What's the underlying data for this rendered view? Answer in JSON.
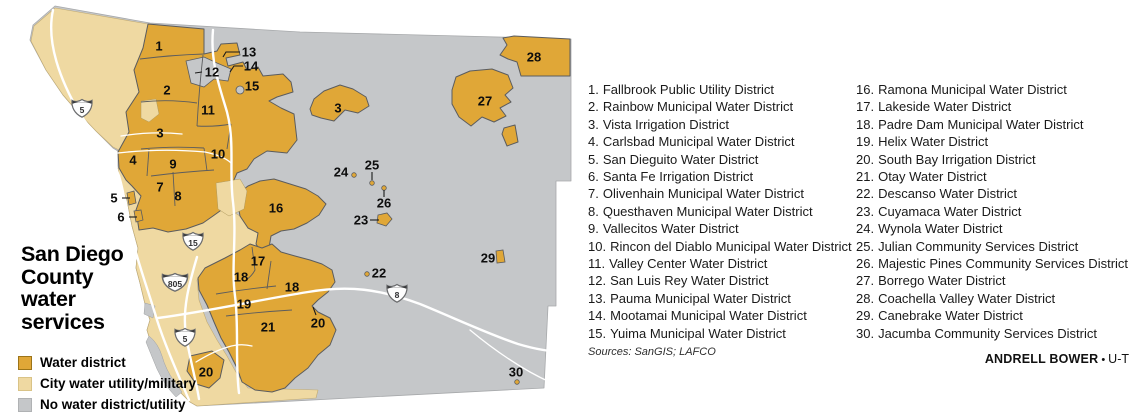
{
  "colors": {
    "gold": "#e0a737",
    "tan": "#efd9a2",
    "gray": "#c5c7c9",
    "border": "#5b5c5e",
    "road": "#ffffff"
  },
  "map_title": {
    "line1": "San Diego",
    "line2": "County",
    "line3": "water",
    "line4": "services"
  },
  "legend": {
    "items": [
      {
        "label": "Water district",
        "color": "#e0a737",
        "border": "#9c7418"
      },
      {
        "label": "City water utility/military",
        "color": "#efd9a2",
        "border": "#d9c387"
      },
      {
        "label": "No water district/utility",
        "color": "#c5c7c9",
        "border": "#b0b2b4"
      }
    ]
  },
  "districts": {
    "column1": [
      {
        "num": "1.",
        "name": "Fallbrook Public Utility District"
      },
      {
        "num": "2.",
        "name": "Rainbow Municipal Water District"
      },
      {
        "num": "3.",
        "name": "Vista Irrigation District"
      },
      {
        "num": "4.",
        "name": "Carlsbad Municipal Water District"
      },
      {
        "num": "5.",
        "name": "San Dieguito Water District"
      },
      {
        "num": "6.",
        "name": "Santa Fe Irrigation District"
      },
      {
        "num": "7.",
        "name": "Olivenhain Municipal Water District"
      },
      {
        "num": "8.",
        "name": "Questhaven Municipal Water District"
      },
      {
        "num": "9.",
        "name": "Vallecitos Water District"
      },
      {
        "num": "10.",
        "name": "Rincon del Diablo Municipal Water District"
      },
      {
        "num": "11.",
        "name": "Valley Center Water District"
      },
      {
        "num": "12.",
        "name": "San Luis Rey Water District"
      },
      {
        "num": "13.",
        "name": "Pauma Municipal Water District"
      },
      {
        "num": "14.",
        "name": "Mootamai Municipal Water District"
      },
      {
        "num": "15.",
        "name": "Yuima Municipal Water District"
      }
    ],
    "column2": [
      {
        "num": "16.",
        "name": "Ramona Municipal Water District"
      },
      {
        "num": "17.",
        "name": "Lakeside Water District"
      },
      {
        "num": "18.",
        "name": "Padre Dam Municipal Water District"
      },
      {
        "num": "19.",
        "name": "Helix Water District"
      },
      {
        "num": "20.",
        "name": "South Bay Irrigation District"
      },
      {
        "num": "21.",
        "name": "Otay Water District"
      },
      {
        "num": "22.",
        "name": "Descanso Water District"
      },
      {
        "num": "23.",
        "name": "Cuyamaca Water District"
      },
      {
        "num": "24.",
        "name": "Wynola Water District"
      },
      {
        "num": "25.",
        "name": "Julian Community Services District"
      },
      {
        "num": "26.",
        "name": "Majestic Pines Community Services District"
      },
      {
        "num": "27.",
        "name": "Borrego Water District"
      },
      {
        "num": "28.",
        "name": "Coachella Valley Water District"
      },
      {
        "num": "29.",
        "name": "Canebrake Water District"
      },
      {
        "num": "30.",
        "name": "Jacumba Community Services District"
      }
    ]
  },
  "sources": "Sources: SanGIS; LAFCO",
  "credit": {
    "byline": "ANDRELL BOWER",
    "bullet": "•",
    "org": "U-T"
  },
  "map": {
    "labels": [
      {
        "n": "1",
        "x": 159,
        "y": 46
      },
      {
        "n": "2",
        "x": 167,
        "y": 90
      },
      {
        "n": "3",
        "x": 160,
        "y": 133
      },
      {
        "n": "3",
        "x": 338,
        "y": 108
      },
      {
        "n": "4",
        "x": 133,
        "y": 160
      },
      {
        "n": "5",
        "x": 114,
        "y": 198
      },
      {
        "n": "6",
        "x": 121,
        "y": 217
      },
      {
        "n": "7",
        "x": 160,
        "y": 187
      },
      {
        "n": "8",
        "x": 178,
        "y": 196
      },
      {
        "n": "9",
        "x": 173,
        "y": 164
      },
      {
        "n": "10",
        "x": 218,
        "y": 154
      },
      {
        "n": "11",
        "x": 208,
        "y": 110
      },
      {
        "n": "12",
        "x": 212,
        "y": 72
      },
      {
        "n": "13",
        "x": 249,
        "y": 52
      },
      {
        "n": "14",
        "x": 251,
        "y": 66
      },
      {
        "n": "15",
        "x": 252,
        "y": 86
      },
      {
        "n": "16",
        "x": 276,
        "y": 208
      },
      {
        "n": "17",
        "x": 258,
        "y": 261
      },
      {
        "n": "18",
        "x": 241,
        "y": 277
      },
      {
        "n": "18",
        "x": 292,
        "y": 287
      },
      {
        "n": "19",
        "x": 244,
        "y": 304
      },
      {
        "n": "20",
        "x": 318,
        "y": 323
      },
      {
        "n": "20",
        "x": 206,
        "y": 372
      },
      {
        "n": "21",
        "x": 268,
        "y": 327
      },
      {
        "n": "22",
        "x": 379,
        "y": 273
      },
      {
        "n": "23",
        "x": 361,
        "y": 220
      },
      {
        "n": "24",
        "x": 341,
        "y": 172
      },
      {
        "n": "25",
        "x": 372,
        "y": 165
      },
      {
        "n": "26",
        "x": 384,
        "y": 203
      },
      {
        "n": "27",
        "x": 485,
        "y": 101
      },
      {
        "n": "28",
        "x": 534,
        "y": 57
      },
      {
        "n": "29",
        "x": 488,
        "y": 258
      },
      {
        "n": "30",
        "x": 516,
        "y": 372
      }
    ],
    "shields": [
      {
        "number": "5"
      },
      {
        "number": "15"
      },
      {
        "number": "805"
      },
      {
        "number": "5"
      },
      {
        "number": "8"
      }
    ]
  }
}
